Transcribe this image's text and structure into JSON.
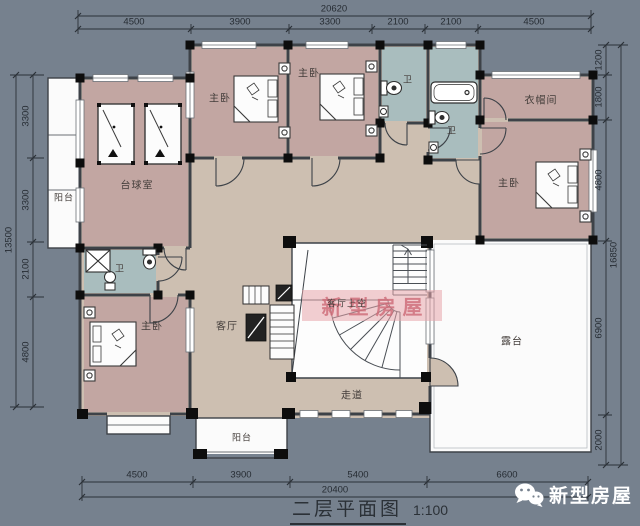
{
  "title": {
    "name": "二层平面图",
    "scale": "1:100"
  },
  "logo": {
    "text": "新型房屋",
    "icon": "wechat-icon"
  },
  "watermark": {
    "text": "新型房屋"
  },
  "rooms": {
    "balcony_left": "阳台",
    "billiard": "台球室",
    "bedroom_top1": "主卧",
    "bedroom_top2": "主卧",
    "bath_top1": "卫",
    "bath_top2": "卫",
    "cloakroom": "衣帽间",
    "bedroom_right": "主卧",
    "bath_left": "卫",
    "bedroom_bottom_left": "主卧",
    "living": "客厅",
    "living_void": "客厅上空",
    "corridor": "走道",
    "terrace": "露台",
    "balcony_bottom": "阳台"
  },
  "dims": {
    "top": {
      "total": "20620",
      "segments": [
        "4500",
        "3900",
        "3300",
        "2100",
        "2100",
        "4500"
      ]
    },
    "bottom": {
      "total": "20400",
      "segments": [
        "4500",
        "3900",
        "5400",
        "6600"
      ]
    },
    "left": {
      "total": "13500",
      "segments": [
        "3300",
        "3300",
        "2100",
        "4800"
      ]
    },
    "right": {
      "total": "16850",
      "segments": [
        "1200",
        "1800",
        "4800",
        "6900",
        "2000"
      ]
    }
  },
  "colors": {
    "background": "#76818e",
    "room_fill": "#c2a6a2",
    "hall_fill": "#cdbfb1",
    "bath_fill": "#a9bdbe",
    "wall": "#3d4248",
    "watermark_pink": "#e7a6ac"
  }
}
